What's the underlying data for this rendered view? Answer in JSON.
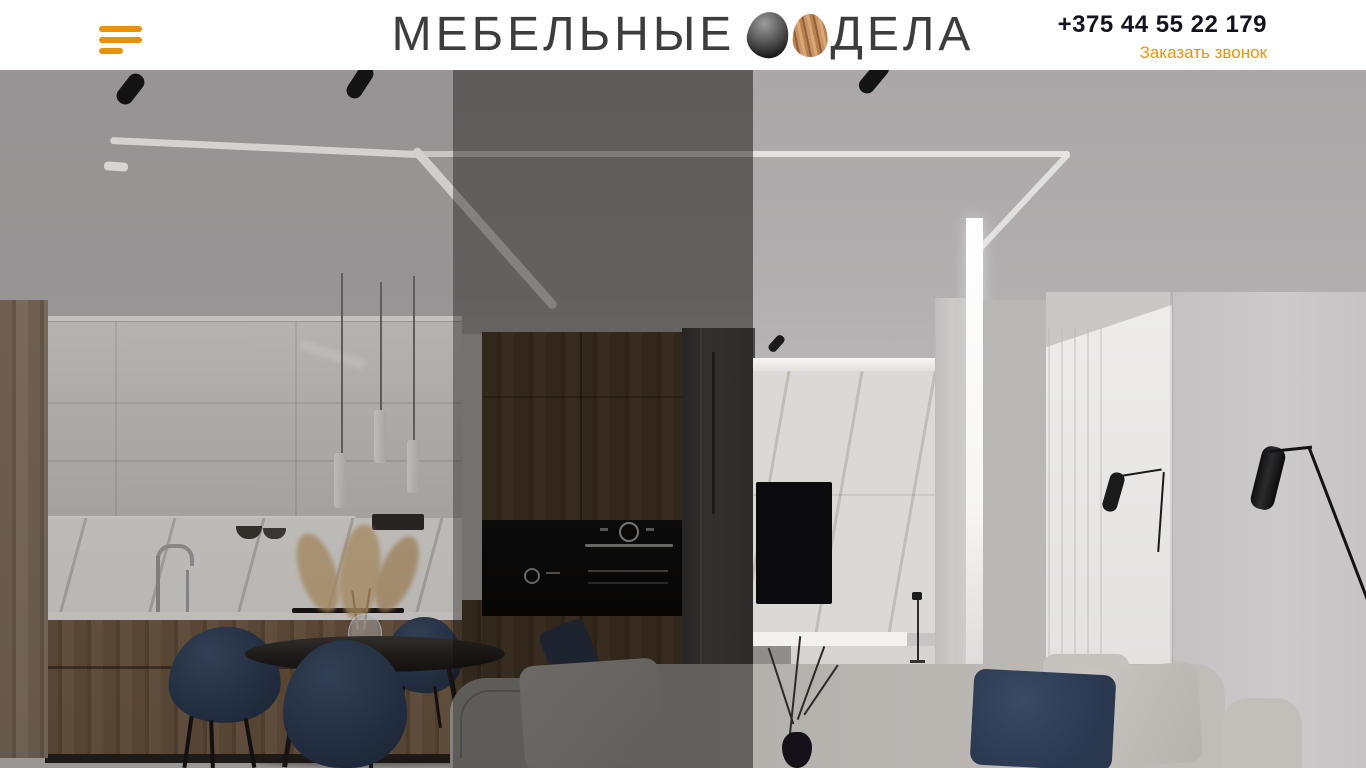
{
  "header": {
    "menu_button": {
      "icon": "hamburger-icon"
    },
    "logo": {
      "word_left": "МЕБЕЛЬНЫЕ",
      "word_right": "ДЕЛА",
      "icons": [
        "dark-stone-egg",
        "wooden-egg"
      ]
    },
    "contact": {
      "phone": "+375 44 55 22 179",
      "call_link": "Заказать звонок"
    }
  },
  "hero": {
    "description": "Modern apartment interior photo: kitchen with wooden cabinets, marble backsplash and white pendant lights; round black dining table with navy velvet chairs; dark wood wardrobe with built-in black ovens; marble TV wall with LED strips and TV; white pillar with vertical LED light; grey sofa with navy and grey pillows; black floor lamps; bright doorway with curtain; two darkened vertical bands over the left half of the photo"
  },
  "colors": {
    "accent_orange": "#E8940E",
    "hamburger_orange": "#E8920C",
    "logo_text": "#3D3D3F",
    "phone_text": "#14141E",
    "header_background": "#FFFFFF",
    "navy_furniture": "#2F3E55",
    "kitchen_wood": "#6E5742",
    "wardrobe_wood": "#56422F"
  }
}
